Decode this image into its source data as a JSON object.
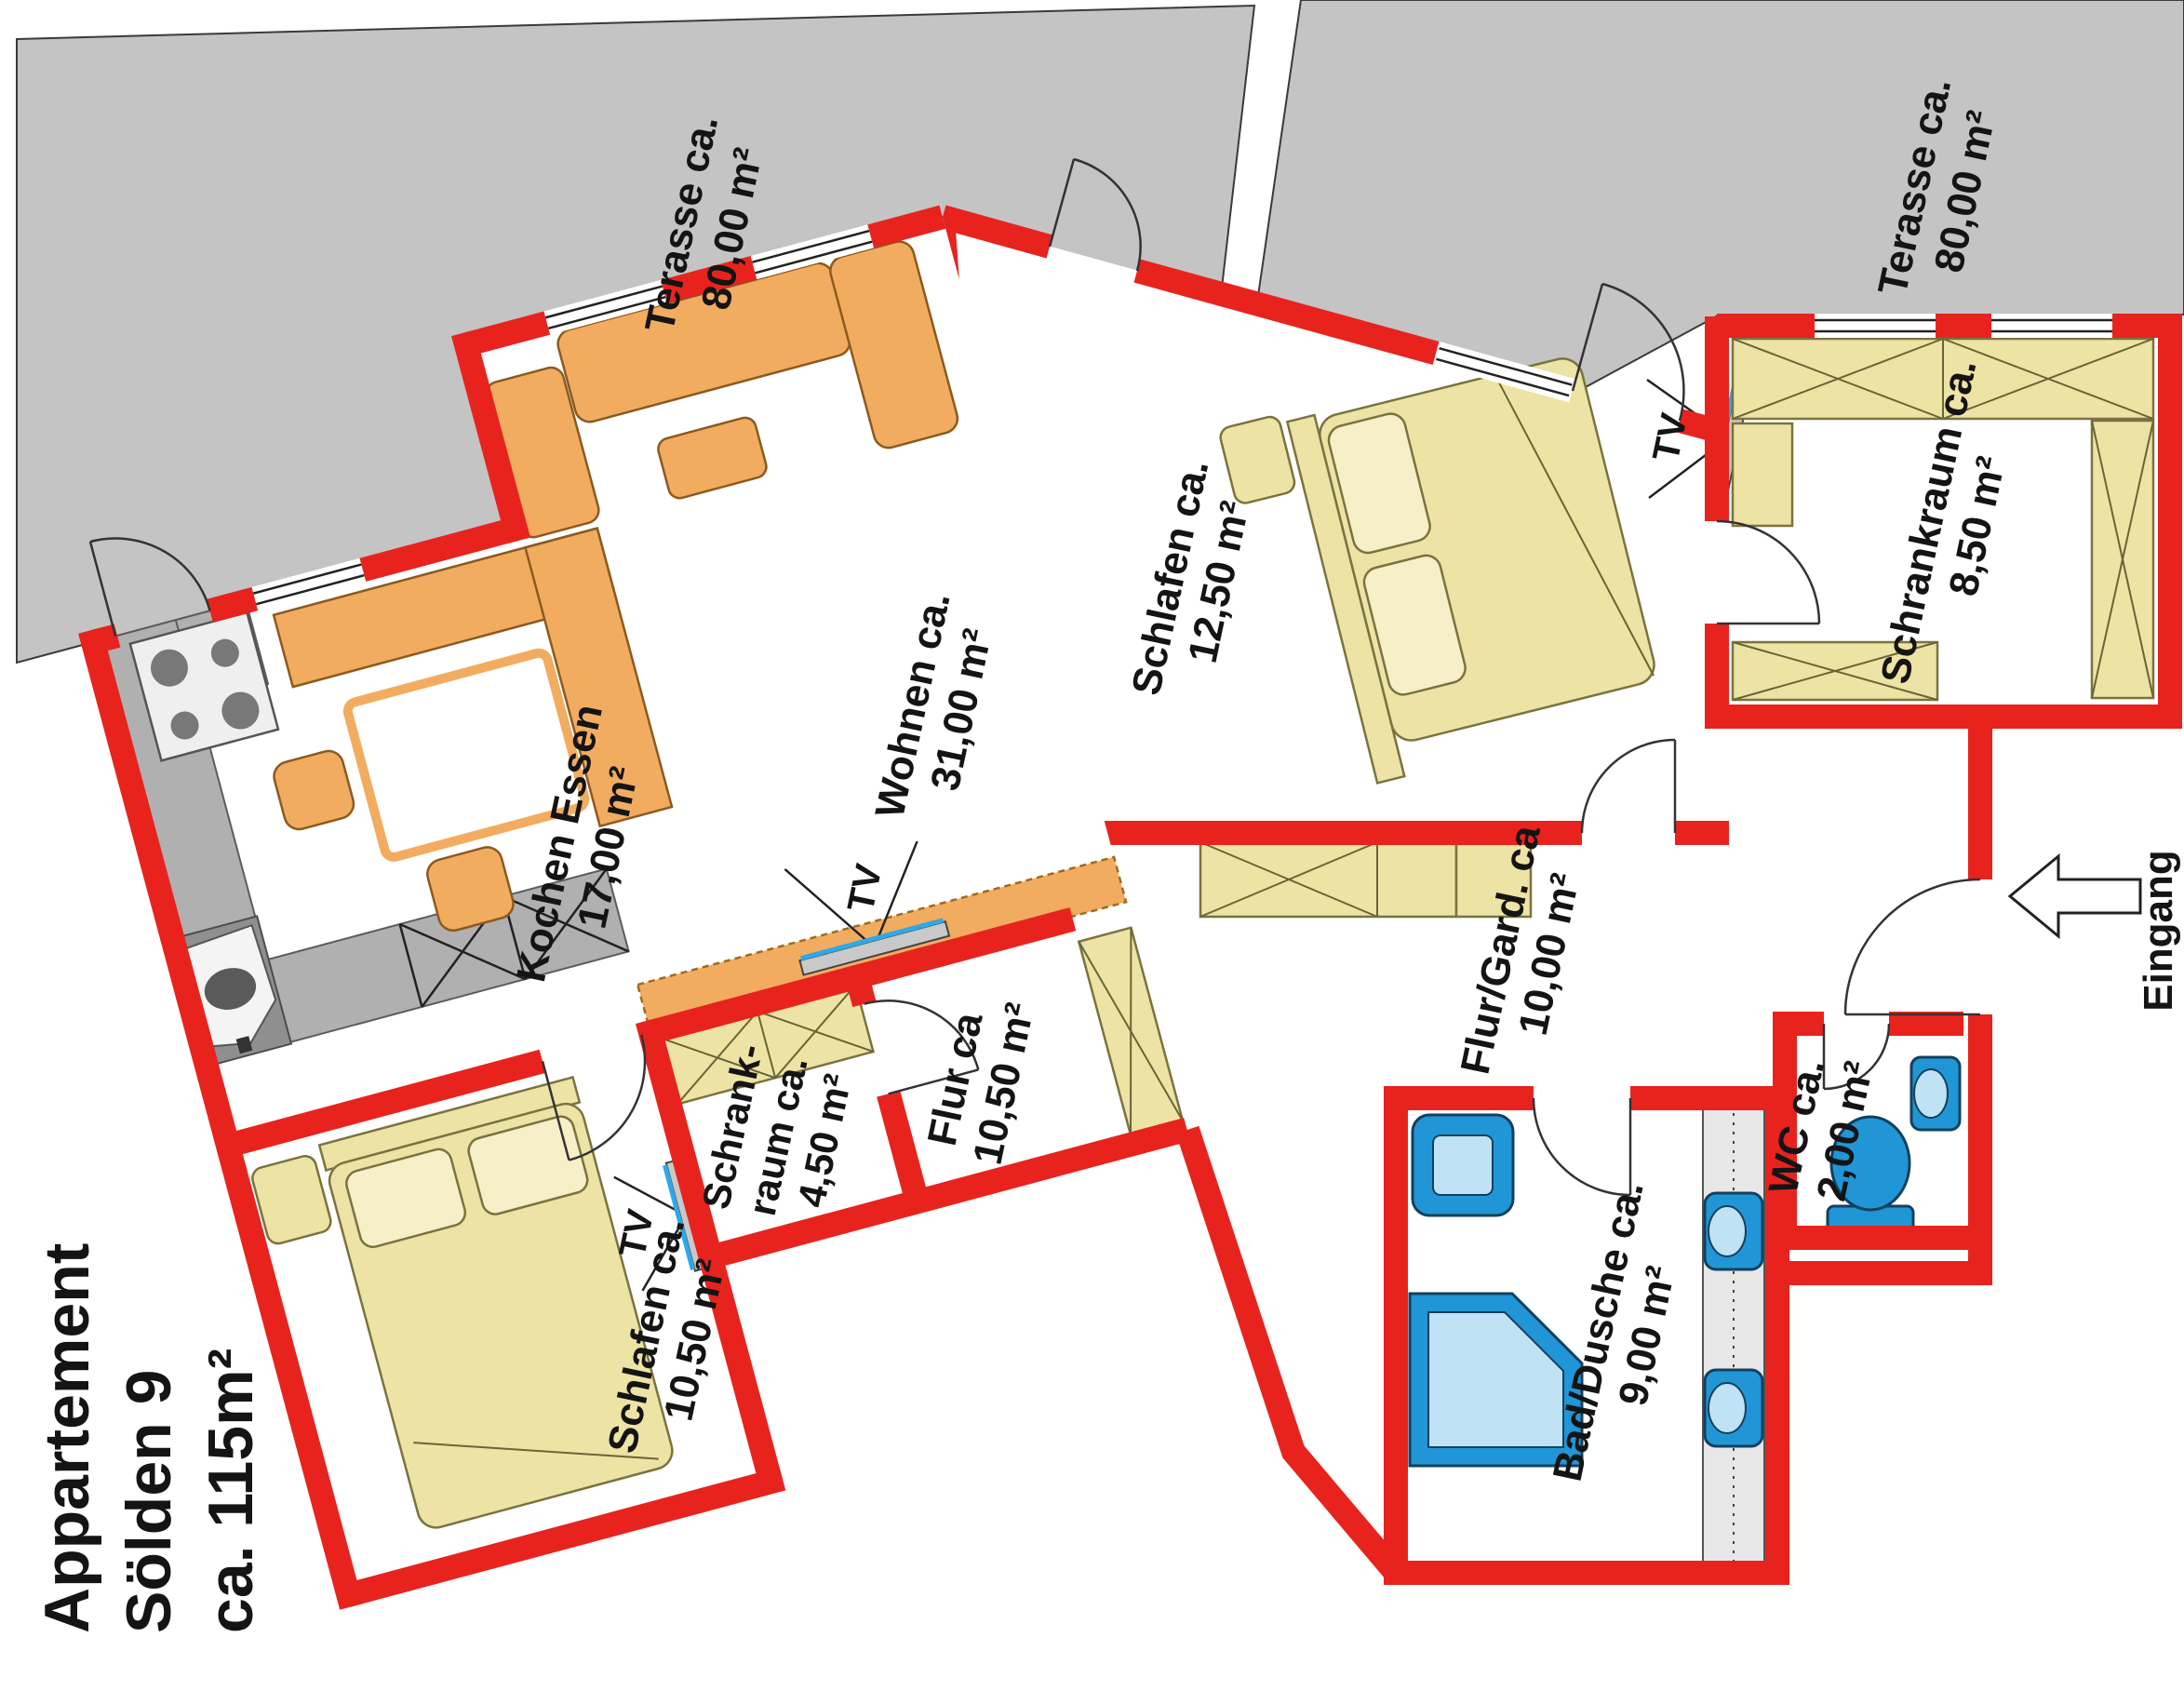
{
  "title": {
    "line1": "Appartement",
    "line2": "Sölden 9",
    "line3": "ca. 115m²"
  },
  "terraces": {
    "left": {
      "name": "Terasse ca.",
      "area": "80,00 m²"
    },
    "right": {
      "name": "Terasse ca.",
      "area": "80,00 m²"
    }
  },
  "rooms": {
    "wohnen": {
      "name": "Wohnen ca.",
      "area": "31,00 m²"
    },
    "kochen": {
      "name": "Kochen Essen",
      "area": "17,00 m²"
    },
    "schlafen_gross": {
      "name": "Schlafen ca.",
      "area": "12,50 m²"
    },
    "schrankraum_gross": {
      "name": "Schrankraum ca.",
      "area": "8,50 m²"
    },
    "flur_gard": {
      "name": "Flur/Gard. ca",
      "area": "10,00 m²"
    },
    "wc": {
      "name": "WC ca.",
      "area": "2,00 m²"
    },
    "bad": {
      "name": "Bad/Dusche ca.",
      "area": "9,00 m²"
    },
    "schrankraum_klein": {
      "line1": "Schrank-",
      "line2": "raum ca.",
      "line3": "4,50 m²"
    },
    "flur": {
      "name": "Flur ca",
      "area": "10,50 m²"
    },
    "schlafen_klein": {
      "name": "Schlafen ca.",
      "area": "10,50 m²"
    }
  },
  "labels": {
    "tv": "TV",
    "eingang": "Eingang"
  },
  "colors": {
    "wall_red": "#e8231e",
    "terrace_gray": "#c4c4c4",
    "furniture_yellow": "#ede3a4",
    "furniture_orange": "#f2ac60",
    "sanitary_blue": "#2196d6"
  }
}
